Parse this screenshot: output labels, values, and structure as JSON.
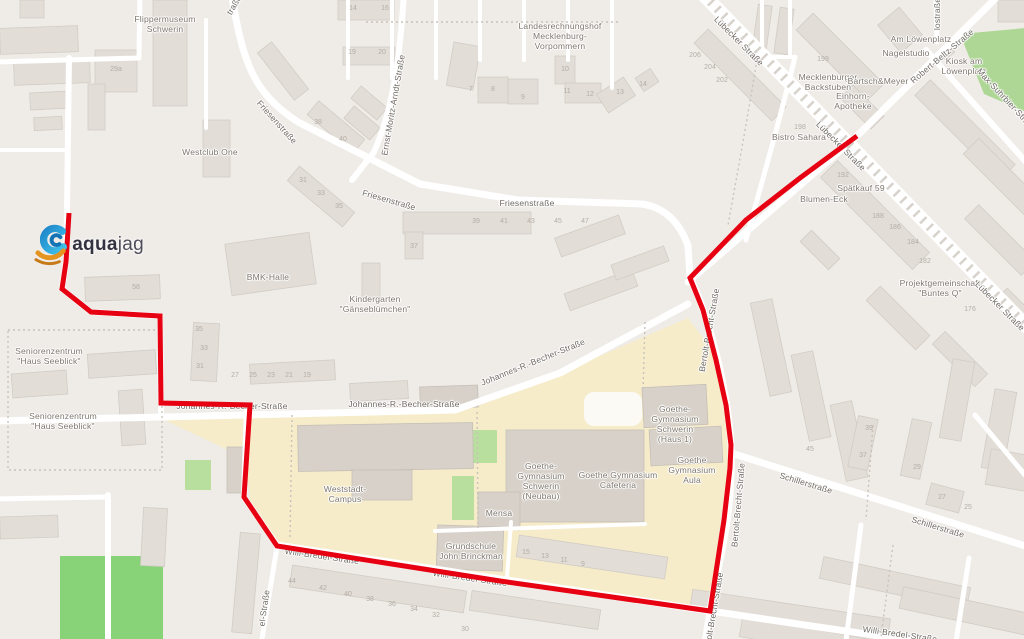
{
  "map": {
    "logo": {
      "bold": "aqua",
      "light": "jag"
    },
    "route": {
      "color": "#e70011",
      "width": 5,
      "points": [
        [
          69,
          213
        ],
        [
          66,
          262
        ],
        [
          62,
          289
        ],
        [
          91,
          312
        ],
        [
          160,
          316
        ],
        [
          161,
          403
        ],
        [
          250,
          405
        ],
        [
          244,
          497
        ],
        [
          277,
          546
        ],
        [
          500,
          581
        ],
        [
          710,
          611
        ],
        [
          716,
          572
        ],
        [
          724,
          520
        ],
        [
          730,
          468
        ],
        [
          731,
          445
        ],
        [
          726,
          405
        ],
        [
          716,
          360
        ],
        [
          703,
          310
        ],
        [
          690,
          278
        ],
        [
          746,
          220
        ],
        [
          800,
          178
        ],
        [
          857,
          136
        ]
      ]
    },
    "colors": {
      "land": "#efece8",
      "building": "#e2ddd7",
      "building_stroke": "#d2ccc5",
      "campus": "#f6ecca",
      "campus_building": "#d7d1c9",
      "campus_building_stroke": "#c5bfb6",
      "green": "#b8df9e",
      "field": "#88d377",
      "park": "#aed795",
      "road": "#ffffff",
      "hatch": "#d7d2cb",
      "dotted": "#c8c2ba",
      "pond": "#fbfaf5"
    },
    "labels": [
      {
        "t": "Flippermuseum\nSchwerin",
        "x": 165,
        "y": 24,
        "r": 0,
        "k": "poi"
      },
      {
        "t": "Westclub One",
        "x": 210,
        "y": 152,
        "r": 0,
        "k": "poi"
      },
      {
        "t": "Landesrechnungshof\nMecklenburg-\nVorpommern",
        "x": 560,
        "y": 36,
        "r": 0,
        "k": "poi"
      },
      {
        "t": "Ernst-Moritz-Arndt-Straße",
        "x": 393,
        "y": 105,
        "r": -80,
        "k": "street"
      },
      {
        "t": "Friesenstraße",
        "x": 277,
        "y": 122,
        "r": 48,
        "k": "street"
      },
      {
        "t": "Friesenstraße",
        "x": 389,
        "y": 200,
        "r": 16,
        "k": "street"
      },
      {
        "t": "Friesenstraße",
        "x": 527,
        "y": 203,
        "r": 0,
        "k": "street"
      },
      {
        "t": "BMK-Halle",
        "x": 268,
        "y": 277,
        "r": 0,
        "k": "poi"
      },
      {
        "t": "Kindergarten\n\"Gänseblümchen\"",
        "x": 375,
        "y": 304,
        "r": 0,
        "k": "poi"
      },
      {
        "t": "Lübecker Straße",
        "x": 739,
        "y": 41,
        "r": 45,
        "k": "street"
      },
      {
        "t": "Mecklenburger\nBackstuben",
        "x": 828,
        "y": 82,
        "r": 0,
        "k": "poi"
      },
      {
        "t": "Bartsch&Meyer",
        "x": 878,
        "y": 81,
        "r": 0,
        "k": "poi"
      },
      {
        "t": "Einhorn-\nApotheke",
        "x": 853,
        "y": 101,
        "r": 0,
        "k": "poi"
      },
      {
        "t": "Am Löwenplatz",
        "x": 921,
        "y": 39,
        "r": 0,
        "k": "poi"
      },
      {
        "t": "Nagelstudio",
        "x": 906,
        "y": 53,
        "r": 0,
        "k": "poi"
      },
      {
        "t": "Robert-Beltz-Straße",
        "x": 942,
        "y": 56,
        "r": -40,
        "k": "street"
      },
      {
        "t": "Kiosk am\nLöwenplatz",
        "x": 964,
        "y": 66,
        "r": 0,
        "k": "poi"
      },
      {
        "t": "Max-Suhrbier-Straße",
        "x": 1007,
        "y": 100,
        "r": 47,
        "k": "street"
      },
      {
        "t": "lostraße",
        "x": 937,
        "y": 14,
        "r": -90,
        "k": "street"
      },
      {
        "t": "Bistro Sahara",
        "x": 799,
        "y": 137,
        "r": 0,
        "k": "poi"
      },
      {
        "t": "Lübecker Straße",
        "x": 841,
        "y": 146,
        "r": 45,
        "k": "street"
      },
      {
        "t": "Spätkauf 59",
        "x": 861,
        "y": 188,
        "r": 0,
        "k": "poi"
      },
      {
        "t": "Blumen-Eck",
        "x": 824,
        "y": 199,
        "r": 0,
        "k": "poi"
      },
      {
        "t": "Projektgemeinschaft\n\"Buntes Q\"",
        "x": 940,
        "y": 288,
        "r": 0,
        "k": "poi"
      },
      {
        "t": "Lübecker Straße",
        "x": 1000,
        "y": 306,
        "r": 45,
        "k": "street"
      },
      {
        "t": "Seniorenzentrum\n\"Haus Seeblick\"",
        "x": 49,
        "y": 356,
        "r": 0,
        "k": "poi"
      },
      {
        "t": "Seniorenzentrum\n\"Haus Seeblick\"",
        "x": 63,
        "y": 421,
        "r": 0,
        "k": "poi"
      },
      {
        "t": "Johannes-R.-Becher-Straße",
        "x": 232,
        "y": 406,
        "r": 0,
        "k": "street"
      },
      {
        "t": "Johannes-R.-Becher-Straße",
        "x": 404,
        "y": 404,
        "r": 0,
        "k": "street"
      },
      {
        "t": "Johannes-R.-Becher-Straße",
        "x": 533,
        "y": 362,
        "r": -22,
        "k": "street"
      },
      {
        "t": "Bertolt-Brecht-Straße",
        "x": 709,
        "y": 330,
        "r": -80,
        "k": "street"
      },
      {
        "t": "Bertolt-Brecht-Straße",
        "x": 738,
        "y": 505,
        "r": -85,
        "k": "street"
      },
      {
        "t": "Bertolt-Brecht-Straße",
        "x": 713,
        "y": 614,
        "r": -80,
        "k": "street"
      },
      {
        "t": "Schillerstraße",
        "x": 806,
        "y": 483,
        "r": 17,
        "k": "street"
      },
      {
        "t": "Schillerstraße",
        "x": 938,
        "y": 527,
        "r": 17,
        "k": "street"
      },
      {
        "t": "Goethe-\nGymnasium\nSchwerin\n(Haus 1)",
        "x": 675,
        "y": 424,
        "r": 0,
        "k": "poi"
      },
      {
        "t": "Goethe-\nGymnasium\nSchwerin\n(Neubau)",
        "x": 541,
        "y": 481,
        "r": 0,
        "k": "poi"
      },
      {
        "t": "Goethe Gymnasium\nCafeteria",
        "x": 618,
        "y": 480,
        "r": 0,
        "k": "poi"
      },
      {
        "t": "Goethe\nGymnasium\nAula",
        "x": 692,
        "y": 470,
        "r": 0,
        "k": "poi"
      },
      {
        "t": "Mensa",
        "x": 499,
        "y": 513,
        "r": 0,
        "k": "poi"
      },
      {
        "t": "Grundschule\nJohn Brinckman",
        "x": 471,
        "y": 551,
        "r": 0,
        "k": "poi"
      },
      {
        "t": "Weststadt-\nCampus",
        "x": 345,
        "y": 494,
        "r": 0,
        "k": "poi"
      },
      {
        "t": "Willi-Bredel-Straße",
        "x": 322,
        "y": 556,
        "r": 8,
        "k": "street"
      },
      {
        "t": "Willi-Bredel-Straße",
        "x": 470,
        "y": 578,
        "r": 8,
        "k": "street"
      },
      {
        "t": "Willi-Bredel-Straße",
        "x": 900,
        "y": 634,
        "r": 8,
        "k": "street"
      },
      {
        "t": "traße",
        "x": 234,
        "y": 5,
        "r": -60,
        "k": "street"
      },
      {
        "t": "el-Straße",
        "x": 264,
        "y": 608,
        "r": -82,
        "k": "street"
      }
    ],
    "house_numbers": [
      [
        "39",
        476,
        222
      ],
      [
        "41",
        504,
        222
      ],
      [
        "43",
        531,
        222
      ],
      [
        "45",
        558,
        222
      ],
      [
        "47",
        585,
        222
      ],
      [
        "37",
        414,
        247
      ],
      [
        "31",
        303,
        181
      ],
      [
        "33",
        321,
        194
      ],
      [
        "35",
        339,
        207
      ],
      [
        "38",
        318,
        123
      ],
      [
        "40",
        343,
        140
      ],
      [
        "14",
        353,
        9
      ],
      [
        "16",
        385,
        9
      ],
      [
        "19",
        352,
        53
      ],
      [
        "20",
        382,
        53
      ],
      [
        "27",
        235,
        376
      ],
      [
        "25",
        253,
        376
      ],
      [
        "23",
        271,
        376
      ],
      [
        "21",
        289,
        376
      ],
      [
        "19",
        307,
        376
      ],
      [
        "29a",
        116,
        70
      ],
      [
        "7",
        471,
        90
      ],
      [
        "8",
        493,
        90
      ],
      [
        "9",
        523,
        98
      ],
      [
        "10",
        565,
        70
      ],
      [
        "11",
        567,
        92
      ],
      [
        "12",
        590,
        95
      ],
      [
        "13",
        620,
        93
      ],
      [
        "14",
        643,
        85
      ],
      [
        "44",
        292,
        582
      ],
      [
        "42",
        323,
        589
      ],
      [
        "40",
        348,
        595
      ],
      [
        "38",
        370,
        600
      ],
      [
        "36",
        392,
        605
      ],
      [
        "34",
        414,
        610
      ],
      [
        "32",
        436,
        616
      ],
      [
        "30",
        465,
        630
      ],
      [
        "15",
        526,
        553
      ],
      [
        "13",
        545,
        557
      ],
      [
        "11",
        564,
        561
      ],
      [
        "9",
        583,
        565
      ],
      [
        "206",
        695,
        56
      ],
      [
        "204",
        710,
        68
      ],
      [
        "202",
        722,
        81
      ],
      [
        "199",
        823,
        60
      ],
      [
        "198",
        800,
        128
      ],
      [
        "192",
        843,
        176
      ],
      [
        "188",
        878,
        217
      ],
      [
        "186",
        895,
        228
      ],
      [
        "184",
        913,
        243
      ],
      [
        "182",
        925,
        262
      ],
      [
        "176",
        970,
        310
      ],
      [
        "45",
        810,
        450
      ],
      [
        "39",
        869,
        429
      ],
      [
        "37",
        863,
        456
      ],
      [
        "29",
        917,
        468
      ],
      [
        "27",
        942,
        498
      ],
      [
        "25",
        968,
        508
      ],
      [
        "35",
        199,
        330
      ],
      [
        "33",
        204,
        349
      ],
      [
        "31",
        200,
        367
      ],
      [
        "58",
        136,
        288
      ]
    ]
  }
}
